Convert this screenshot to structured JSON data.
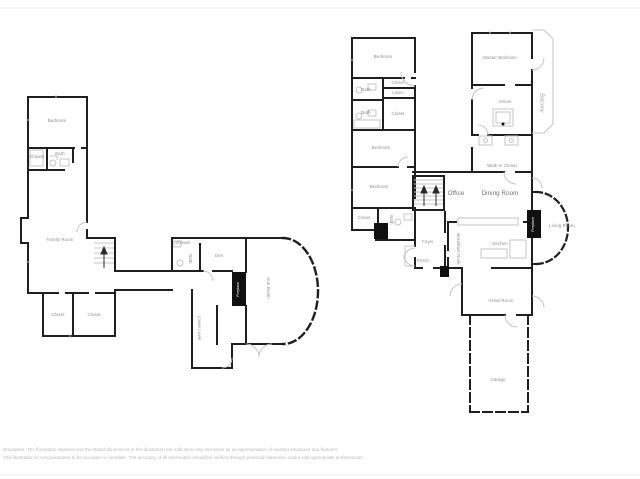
{
  "colors": {
    "wall": "#1f1f1f",
    "detail": "#c4c4c4",
    "label": "#8b8b8b",
    "fireplace_fill": "#101010",
    "disclaimer_text": "#b9b9b9"
  },
  "left_plan": {
    "bedroom": "Bedroom",
    "shower": "Shower",
    "bath_upper": "Bath",
    "family_room": "Family Room",
    "closet_left": "Closet",
    "closet_right": "Closet",
    "shower_2": "Shower",
    "bath_middle": "Bath",
    "den": "Den",
    "fireplace": "Fireplace",
    "sun_room": "Sun Room",
    "lower_level": "Lower Level"
  },
  "right_plan": {
    "bedroom_top": "Bedroom",
    "bath_1": "Bath",
    "closet_1": "Closet",
    "linen": "Linen",
    "bath_2": "Bath",
    "closet_2": "Closet",
    "bedroom_middle": "Bedroom",
    "bedroom_lower": "Bedroom",
    "closet_3": "Closet",
    "bath_3": "Bath",
    "office": "Office",
    "dining_room": "Dining Room",
    "walk_in_closet": "Walk-In Closet",
    "atrium": "Atrium",
    "master_bedroom": "Master Bedroom",
    "balcony": "Balcony",
    "living_room": "Living Room",
    "fireplace": "Fireplace",
    "kitchen": "Kitchen",
    "breakfast_nook": "Breakfast Nook",
    "foyer": "Foyer",
    "porch": "Porch",
    "great_room": "Great Room",
    "garage": "Garage"
  },
  "disclaimer": {
    "line_1": "Disclaimer: The floorplans depicted and the stated dimensions in this illustration are indicative only and serve as an approximation of existing structures and features.",
    "line_2": "This illustration is not guaranteed to be accurate or complete. The accuracy of all information should be verified through personal inspection and/or with appropriate professionals."
  }
}
